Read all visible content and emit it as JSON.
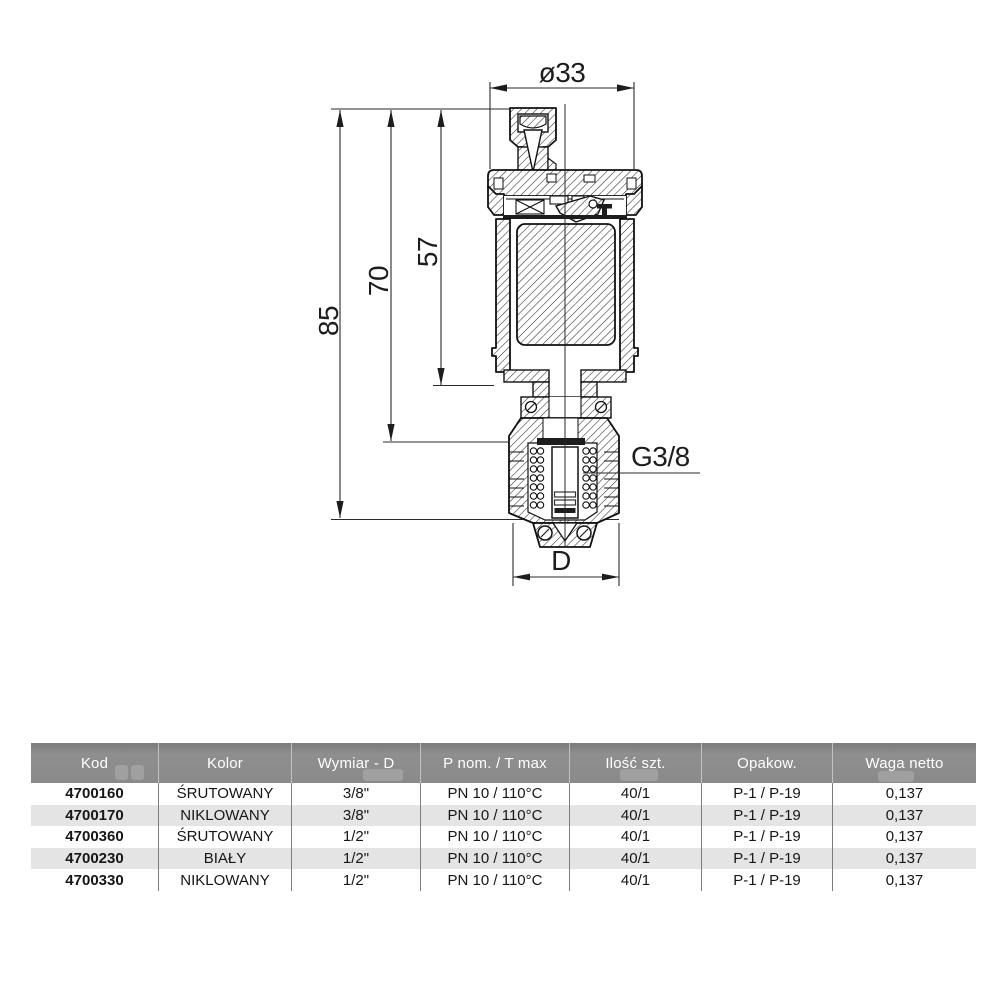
{
  "drawing": {
    "dims": {
      "diameter_top": "ø33",
      "height_total": "85",
      "height_mid": "70",
      "height_upper": "57",
      "thread": "G3/8",
      "outlet": "D"
    }
  },
  "table": {
    "headers": [
      "Kod",
      "Kolor",
      "Wymiar - D",
      "P nom. / T max",
      "Ilość szt.",
      "Opakow.",
      "Waga netto"
    ],
    "rows": [
      [
        "4700160",
        "ŚRUTOWANY",
        "3/8\"",
        "PN 10 / 110°C",
        "40/1",
        "P-1 / P-19",
        "0,137"
      ],
      [
        "4700170",
        "NIKLOWANY",
        "3/8\"",
        "PN 10 / 110°C",
        "40/1",
        "P-1 / P-19",
        "0,137"
      ],
      [
        "4700360",
        "ŚRUTOWANY",
        "1/2\"",
        "PN 10 / 110°C",
        "40/1",
        "P-1 / P-19",
        "0,137"
      ],
      [
        "4700230",
        "BIAŁY",
        "1/2\"",
        "PN 10 / 110°C",
        "40/1",
        "P-1 / P-19",
        "0,137"
      ],
      [
        "4700330",
        "NIKLOWANY",
        "1/2\"",
        "PN 10 / 110°C",
        "40/1",
        "P-1 / P-19",
        "0,137"
      ]
    ]
  },
  "colors": {
    "header_bg": "#8a8a8a",
    "row_alt": "#e4e4e4",
    "ink": "#1d1d1d"
  }
}
